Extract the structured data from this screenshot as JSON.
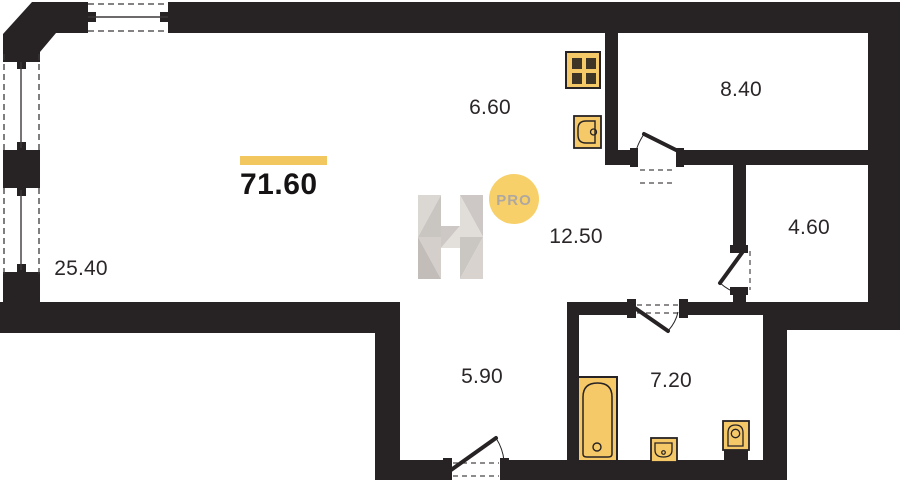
{
  "plan": {
    "total_area": "71.60",
    "rooms": [
      {
        "id": "room-left",
        "area": "25.40"
      },
      {
        "id": "room-top-middle",
        "area": "6.60"
      },
      {
        "id": "room-top-right",
        "area": "8.40"
      },
      {
        "id": "room-middle",
        "area": "12.50"
      },
      {
        "id": "room-right",
        "area": "4.60"
      },
      {
        "id": "room-bottom-middle",
        "area": "5.90"
      },
      {
        "id": "room-bottom-right",
        "area": "7.20"
      }
    ],
    "fixtures": [
      "stove-icon",
      "kitchen-sink-icon",
      "bathtub-icon",
      "washbasin-icon",
      "toilet-icon"
    ],
    "windows_count": 3,
    "doors_count": 4
  },
  "watermark": {
    "badge_label": "PRO"
  },
  "colors": {
    "wall": "#272324",
    "accent_bar": "#F2C75F",
    "fixture_fill": "#F5C868",
    "fixture_detail": "#3E3526",
    "badge_fill": "#F7CE63",
    "badge_text": "#ABA49C",
    "label_text": "#2b2627"
  }
}
